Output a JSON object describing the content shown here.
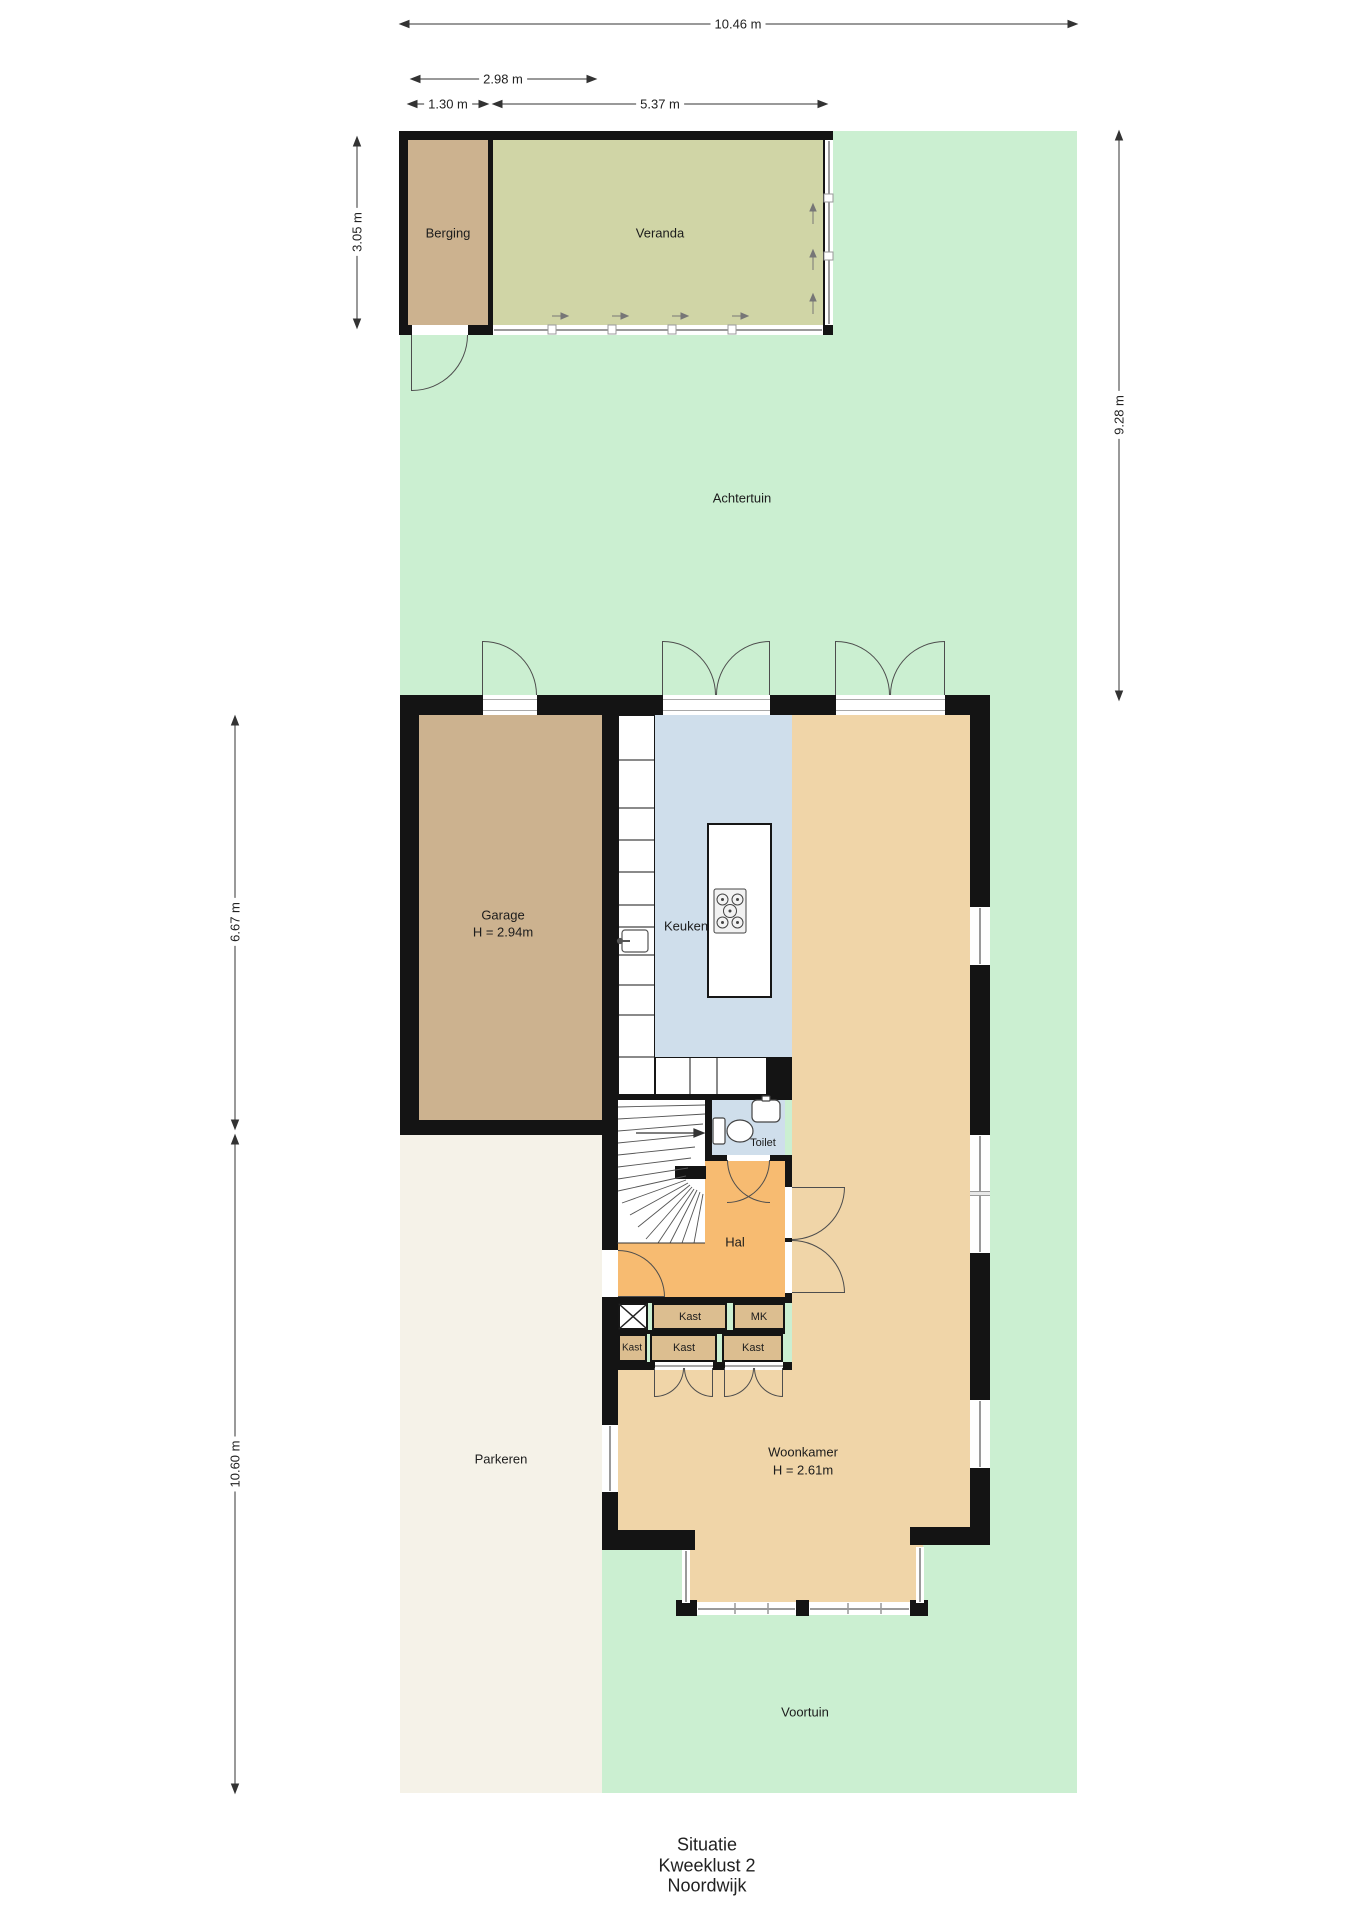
{
  "title": {
    "line1": "Situatie",
    "line2": "Kweeklust 2",
    "line3": "Noordwijk"
  },
  "labels": {
    "berging": "Berging",
    "veranda": "Veranda",
    "achtertuin": "Achtertuin",
    "garage": "Garage",
    "garage_height": "H = 2.94m",
    "keuken": "Keuken",
    "toilet": "Toilet",
    "hal": "Hal",
    "kast": "Kast",
    "mk": "MK",
    "woonkamer": "Woonkamer",
    "woonkamer_height": "H = 2.61m",
    "parkeren": "Parkeren",
    "voortuin": "Voortuin"
  },
  "dimensions": {
    "plot_width": "10.46 m",
    "berging_outer_width": "2.98 m",
    "berging_width": "1.30 m",
    "veranda_width": "5.37 m",
    "berging_depth": "3.05 m",
    "achtertuin_depth": "9.28 m",
    "garage_section_depth": "6.67 m",
    "parkeren_depth": "10.60 m"
  },
  "colors": {
    "garden": "#cbefd1",
    "veranda": "#d0d5a6",
    "shed": "#ccb28f",
    "kitchen": "#cfdeeb",
    "living": "#f0d5a8",
    "closet": "#dcbe90",
    "hall": "#f7bb71",
    "parking": "#f5f2e8",
    "wall": "#141414"
  }
}
